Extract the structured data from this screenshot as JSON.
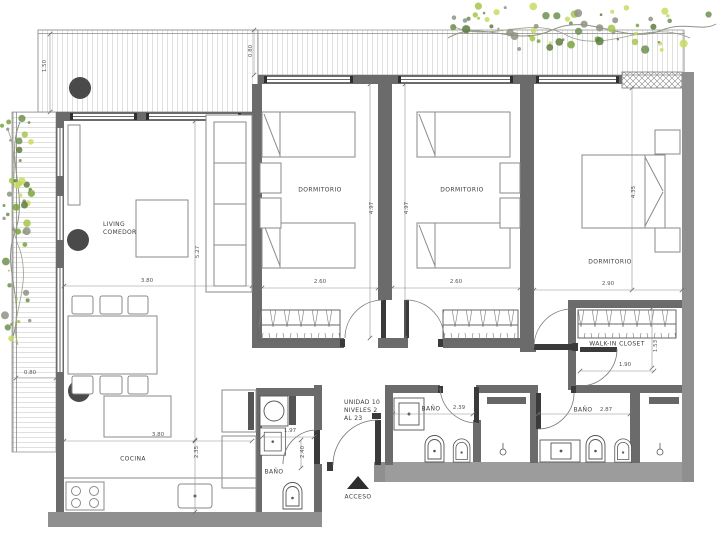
{
  "unit_info": {
    "line1": "UNIDAD 10",
    "line2": "NIVELES 2",
    "line3": "AL 23"
  },
  "rooms": {
    "living": {
      "line1": "LIVING",
      "line2": "COMEDOR",
      "width": "3.80",
      "depth": "5.27"
    },
    "dormitorio1": {
      "label": "DORMITORIO",
      "width": "2.60",
      "depth": "4.97"
    },
    "dormitorio2": {
      "label": "DORMITORIO",
      "width": "2.60",
      "depth": "4.97"
    },
    "dormitorio3": {
      "label": "DORMITORIO",
      "width": "2.90",
      "depth": "4.35"
    },
    "cocina": {
      "label": "COCINA",
      "width": "3.80",
      "depth": "2.35"
    },
    "bano_servicio": {
      "label": "BAÑO",
      "width": "1.97",
      "depth": "2.40"
    },
    "bano2": {
      "label": "BAÑO",
      "width": "2.39"
    },
    "bano3": {
      "label": "BAÑO",
      "width": "2.87"
    },
    "walkin": {
      "label": "WALK-IN CLOSET",
      "width": "1.90",
      "depth": "1.53"
    },
    "acceso": {
      "label": "ACCESO"
    }
  },
  "terrace_dims": {
    "top_left": "1.50",
    "top_right": "0.80",
    "left": "0.80"
  },
  "colors": {
    "wall": "#6b6b6b",
    "wall_light": "#9c9c9c",
    "line": "#555555",
    "foliage_green": "#79a43e",
    "foliage_light": "#a6c64d",
    "foliage_gray": "#8d9383"
  }
}
